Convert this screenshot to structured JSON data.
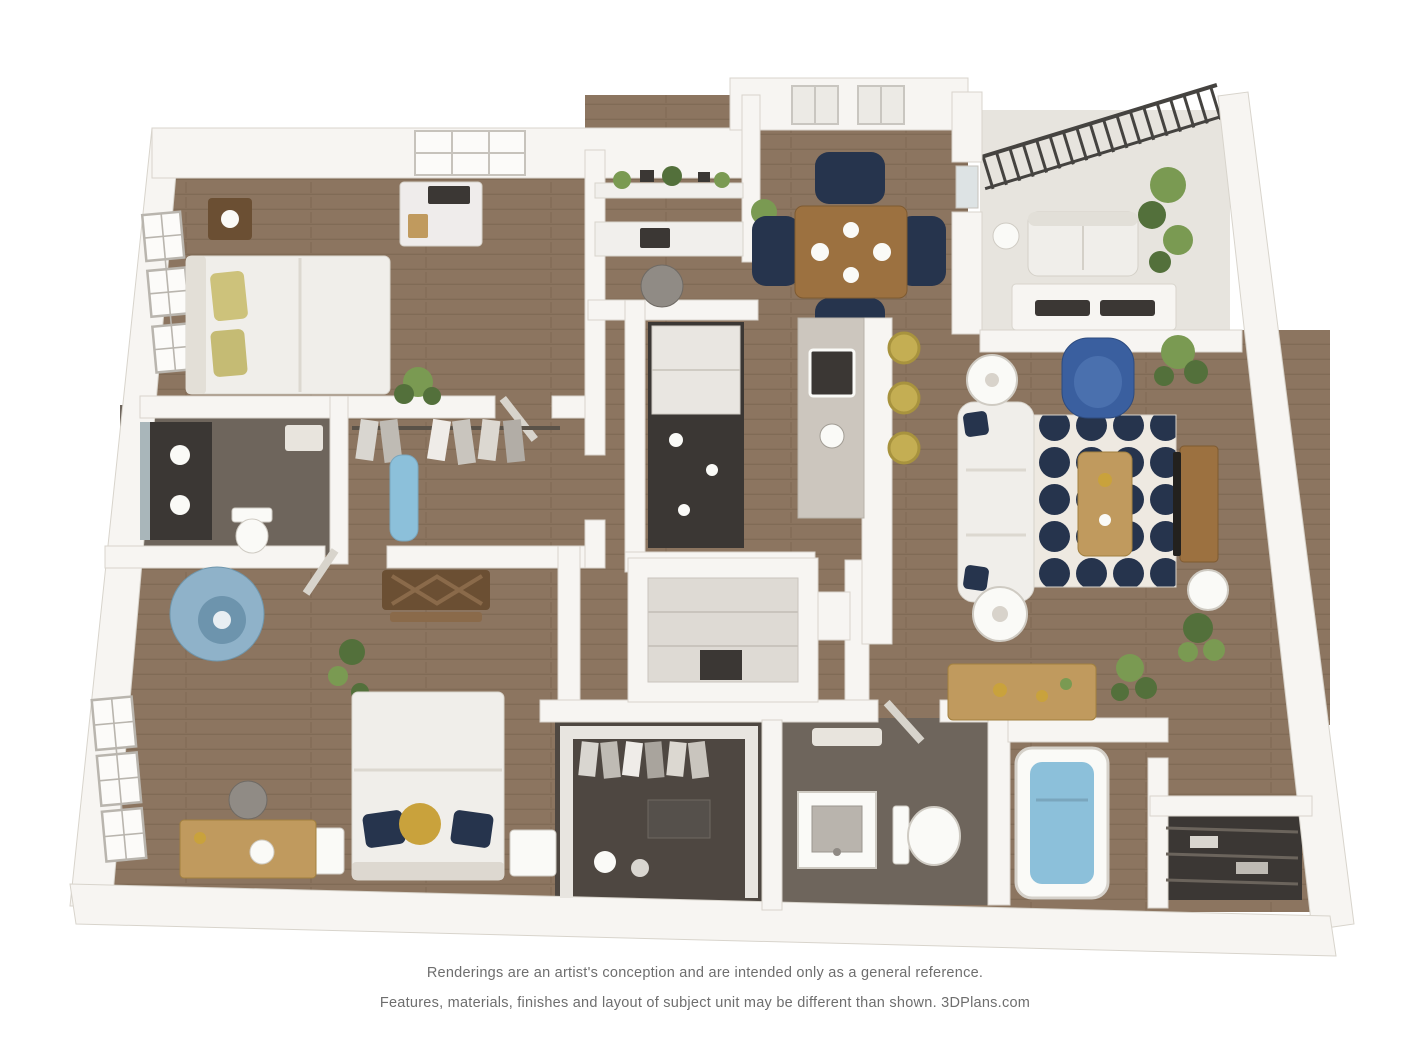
{
  "document": {
    "title": "3D apartment floor plan rendering"
  },
  "disclaimer": {
    "line1": "Renderings are an artist's conception and are intended only as a general reference.",
    "line2": "Features, materials, finishes and layout of subject unit may be different than shown.  3DPlans.com"
  },
  "rooms": [
    "primary-bedroom",
    "primary-bathroom",
    "wardrobe-closet",
    "study-nook",
    "entry-dining",
    "kitchen",
    "pantry-closet",
    "balcony",
    "living-room",
    "second-bedroom",
    "walk-in-closet",
    "second-bathroom",
    "bathtub-room",
    "linen-closet"
  ],
  "palette": {
    "wall": "#f7f5f2",
    "wallEdge": "#d8d4cc",
    "floorWood": "#8c7560",
    "plankLine": "#77624e",
    "floorBath": "#6e655c",
    "closetDark": "#4e4741",
    "balconyFloor": "#e7e4de",
    "navy": "#26344d",
    "rugBg": "#eee9e1",
    "blueChair": "#3a5f9f",
    "softBlue": "#8fb2c9",
    "aqua": "#8cc0da",
    "yellow": "#c4ae53",
    "gold": "#c9a23c",
    "woodFurn": "#9c7140",
    "woodLight": "#c09a5e",
    "woodDark": "#6b4f33",
    "sofa": "#f0eeea",
    "fixtureWhite": "#fafaf7",
    "gray": "#908b85",
    "green": "#7a9a52",
    "greenDark": "#53703b",
    "charcoal": "#3b3734",
    "mirror": "#a9b6ba",
    "railing": "#454340",
    "textGray": "#6e6e6e"
  }
}
